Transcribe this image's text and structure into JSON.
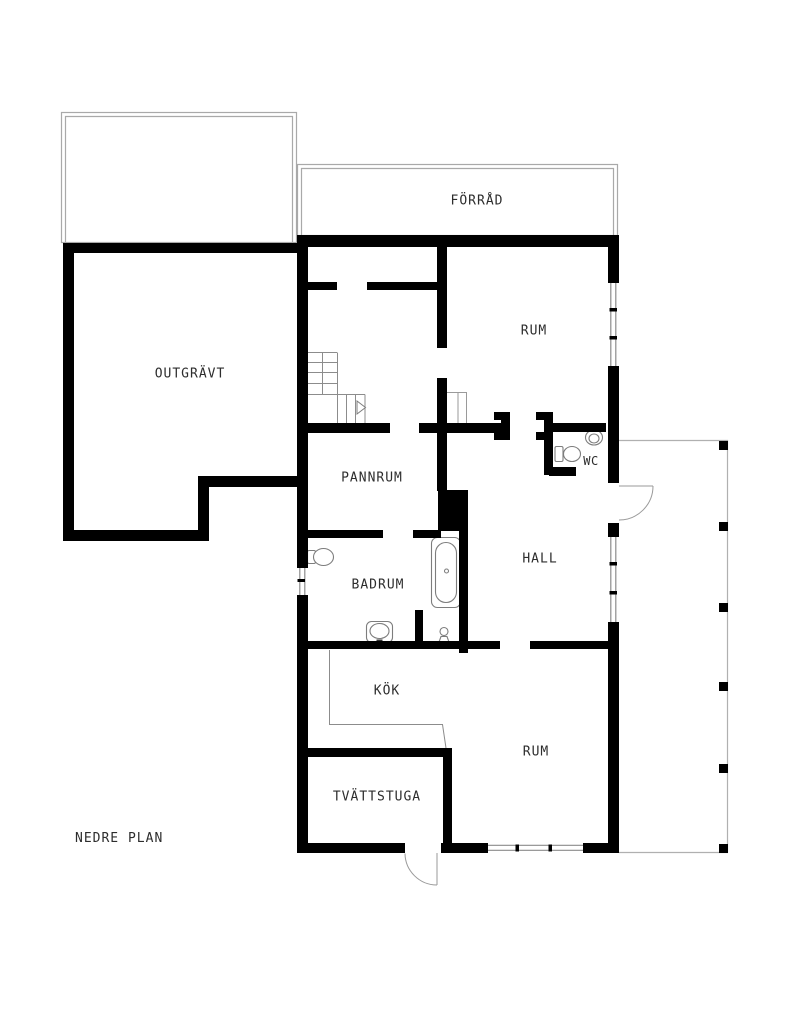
{
  "plan_title": "NEDRE PLAN",
  "rooms": {
    "forrad": {
      "label": "FÖRRÅD"
    },
    "outgravt": {
      "label": "OUTGRÄVT"
    },
    "rum_upper": {
      "label": "RUM"
    },
    "pannrum": {
      "label": "PANNRUM"
    },
    "wc": {
      "label": "WC"
    },
    "hall": {
      "label": "HALL"
    },
    "badrum": {
      "label": "BADRUM"
    },
    "kok": {
      "label": "KÖK"
    },
    "rum_lower": {
      "label": "RUM"
    },
    "tvattstuga": {
      "label": "TVÄTTSTUGA"
    }
  },
  "fixtures": {
    "wc": [
      "toilet",
      "sink"
    ],
    "badrum": [
      "toilet",
      "bathtub",
      "sink",
      "pedestal-sink"
    ],
    "features": [
      "stairs",
      "stair-direction-arrow",
      "chimney",
      "kitchen-counter",
      "closet",
      "door-arcs",
      "windows"
    ]
  },
  "terrace": {
    "post_count": 6
  },
  "colors": {
    "wall": "#000000",
    "background": "#ffffff",
    "text": "#2d2d2d",
    "fixture_line": "#7d7d7d",
    "light_outline": "#a9a9a9"
  }
}
